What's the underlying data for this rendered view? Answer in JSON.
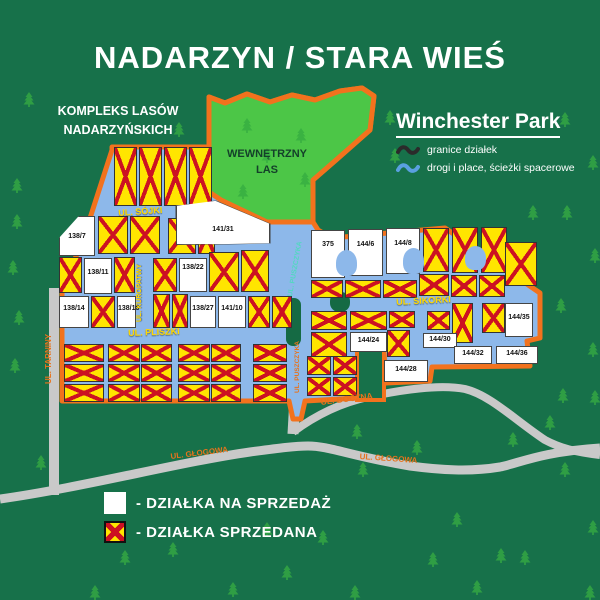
{
  "title": "NADARZYN / STARA WIEŚ",
  "outer_forest": {
    "line1": "KOMPLEKS LASÓW",
    "line2": "NADARZYŃSKICH"
  },
  "park": {
    "name": "Winchester Park",
    "legend": [
      {
        "icon": "boundary-squiggle-icon",
        "label": "granice działek"
      },
      {
        "icon": "road-squiggle-icon",
        "label": "drogi i place, ścieżki spacerowe"
      }
    ]
  },
  "inner_forest": {
    "line1": "WEWNĘTRZNY",
    "line2": "LAS"
  },
  "streets": [
    {
      "id": "sojki",
      "name": "UL. SÓJKI"
    },
    {
      "id": "kuropatwy",
      "name": "UL. KUROPATWY"
    },
    {
      "id": "pliszki",
      "name": "UL. PLISZKI"
    },
    {
      "id": "puszczyka_upper",
      "name": "UL. PUSZCZYKA"
    },
    {
      "id": "puszczyka_lower",
      "name": "UL. PUSZCZYKA"
    },
    {
      "id": "sikorki",
      "name": "UL. SIKORKI"
    },
    {
      "id": "tarniny",
      "name": "UL. TARNINY"
    },
    {
      "id": "boczna",
      "name": "UL. BOCZNA"
    },
    {
      "id": "glogowa_west",
      "name": "UL. GŁOGOWA"
    },
    {
      "id": "glogowa_east",
      "name": "UL. GŁOGOWA"
    }
  ],
  "sale_plots": [
    {
      "number": "138/7"
    },
    {
      "number": "138/11"
    },
    {
      "number": "138/14"
    },
    {
      "number": "138/16"
    },
    {
      "number": "138/22"
    },
    {
      "number": "138/27"
    },
    {
      "number": "141/10"
    },
    {
      "number": "141/31"
    },
    {
      "number": "375"
    },
    {
      "number": "144/6"
    },
    {
      "number": "144/8"
    },
    {
      "number": "144/35"
    },
    {
      "number": "144/24"
    },
    {
      "number": "144/30"
    },
    {
      "number": "144/28"
    },
    {
      "number": "144/32"
    },
    {
      "number": "144/36"
    }
  ],
  "legend": {
    "for_sale": "- DZIAŁKA NA SPRZEDAŻ",
    "sold": "- DZIAŁKA SPRZEDANA"
  },
  "colors": {
    "background": "#17714a",
    "inner_forest": "#4cc647",
    "boundary": "#f2721d",
    "inner_roads": "#8db8ea",
    "outer_roads": "#c9c9c9",
    "plot_sold": "#ffe500",
    "plot_x": "#cc1122",
    "plot_for_sale": "#ffffff",
    "street_text_on_blue": "#ffd800",
    "street_text_on_gray": "#e8731c",
    "tree": "#2f9e44"
  }
}
